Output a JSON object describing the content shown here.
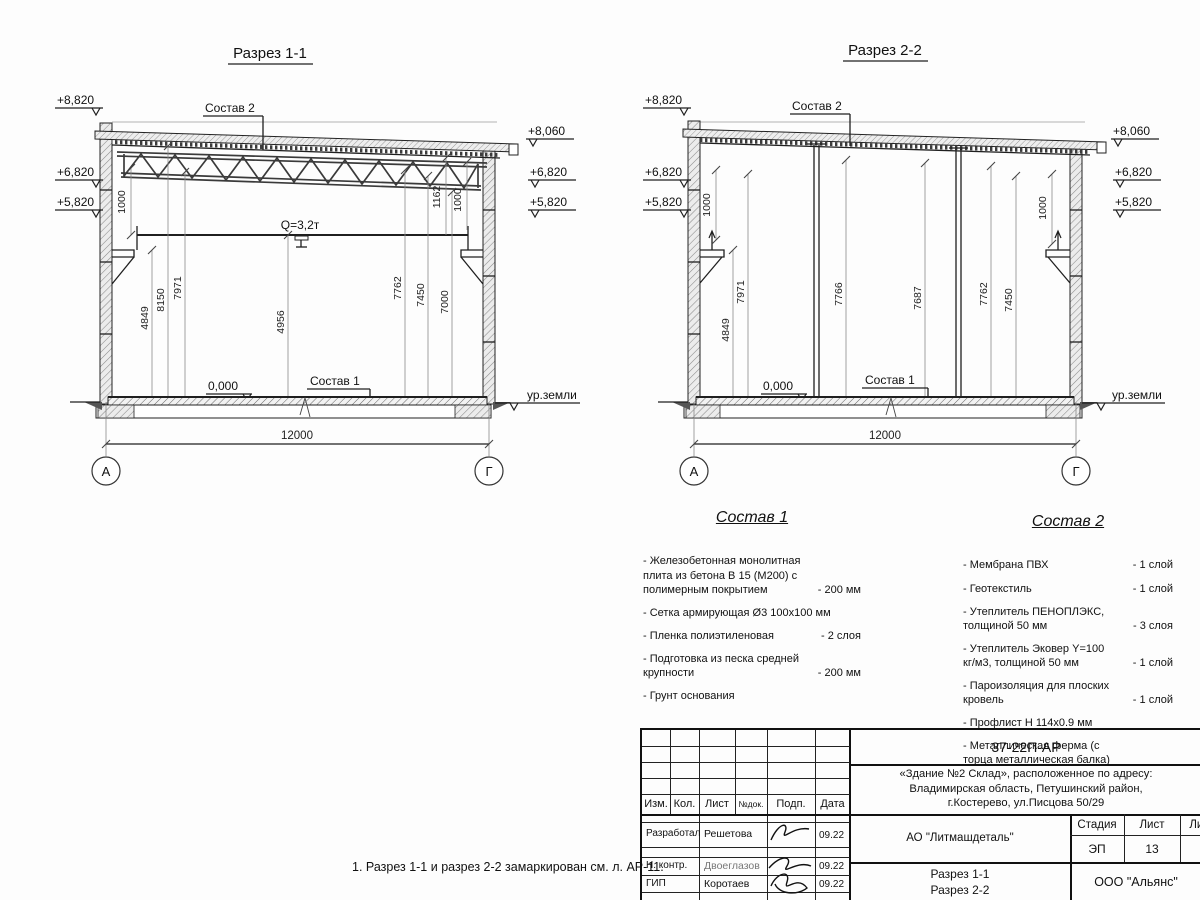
{
  "sections": {
    "s1": {
      "title": "Разрез 1-1",
      "elev_left": [
        "+8,820",
        "+6,820",
        "+5,820"
      ],
      "elev_right": [
        "+8,060",
        "+6,820",
        "+5,820"
      ],
      "roof_ref": "Состав 2",
      "floor_ref": "Состав 1",
      "crane": "Q=3,2т",
      "zero": "0,000",
      "ground": "ур.земли",
      "span": "12000",
      "axis_left": "А",
      "axis_right": "Г",
      "dims": [
        "1000",
        "4849",
        "8150",
        "7971",
        "4956",
        "7762",
        "7450",
        "7000",
        "1162",
        "1000"
      ]
    },
    "s2": {
      "title": "Разрез 2-2",
      "elev_left": [
        "+8,820",
        "+6,820",
        "+5,820"
      ],
      "elev_right": [
        "+8,060",
        "+6,820",
        "+5,820"
      ],
      "roof_ref": "Состав 2",
      "floor_ref": "Состав 1",
      "zero": "0,000",
      "ground": "ур.земли",
      "span": "12000",
      "axis_left": "А",
      "axis_right": "Г",
      "dims": [
        "1000",
        "4849",
        "7971",
        "7766",
        "7687",
        "7762",
        "7450",
        "1000"
      ]
    }
  },
  "sostav1": {
    "title": "Состав 1",
    "items": [
      {
        "text": "- Железобетонная  монолитная плита из бетона В 15 (М200) с полимерным покрытием",
        "qty": "- 200 мм"
      },
      {
        "text": "- Сетка армирующая Ø3 100х100 мм",
        "qty": ""
      },
      {
        "text": "- Пленка полиэтиленовая",
        "qty": "-  2 слоя"
      },
      {
        "text": "- Подготовка из песка средней крупности",
        "qty": "- 200 мм"
      },
      {
        "text": "- Грунт основания",
        "qty": ""
      }
    ]
  },
  "sostav2": {
    "title": "Состав 2",
    "items": [
      {
        "text": "- Мембрана ПВХ",
        "qty": "- 1 слой"
      },
      {
        "text": "- Геотекстиль",
        "qty": "- 1 слой"
      },
      {
        "text": "- Утеплитель ПЕНОПЛЭКС, толщиной 50 мм",
        "qty": "- 3 слоя"
      },
      {
        "text": "- Утеплитель Эковер Y=100 кг/м3, толщиной 50 мм",
        "qty": "- 1 слой"
      },
      {
        "text": "- Пароизоляция для плоских кровель",
        "qty": "- 1 слой"
      },
      {
        "text": "- Профлист Н 114х0.9 мм",
        "qty": ""
      },
      {
        "text": "- Металлическая ферма (с торца металлическая балка)",
        "qty": ""
      }
    ]
  },
  "note": "1. Разрез 1-1 и разрез 2-2 замаркирован см. л. АР-11.",
  "titleblock": {
    "code": "37-22П-АР",
    "project": "«Здание №2 Склад», расположенное по адресу:\nВладимирская область, Петушинский район,\nг.Костерево, ул.Писцова 50/29",
    "cols": [
      "Изм.",
      "Кол.",
      "Лист",
      "№док.",
      "Подп.",
      "Дата"
    ],
    "rows": [
      {
        "role": "Разработал",
        "name": "Решетова",
        "date": "09.22"
      },
      {
        "role": "Н. контр.",
        "name": "Двоеглазов",
        "date": "09.22"
      },
      {
        "role": "ГИП",
        "name": "Коротаев",
        "date": "09.22"
      }
    ],
    "company": "АО \"Литмашдеталь\"",
    "stage_label": "Стадия",
    "sheet_label": "Лист",
    "sheets_label": "Листов",
    "stage": "ЭП",
    "sheet": "13",
    "sheets": "14",
    "drawing": "Разрез 1-1\nРазрез 2-2",
    "org": "ООО \"Альянс\""
  }
}
